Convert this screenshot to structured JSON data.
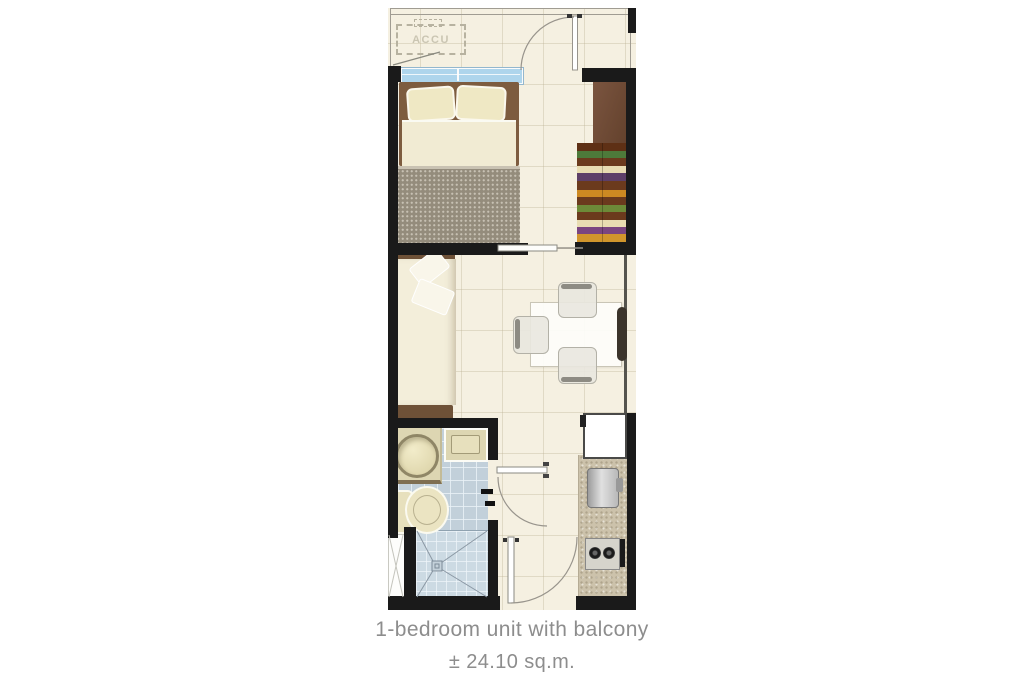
{
  "plan": {
    "accu_label": "ACCU"
  },
  "caption": {
    "title": "1-bedroom unit with balcony",
    "area": "± 24.10 sq.m."
  },
  "colors": {
    "wall": "#1a1a1a",
    "floor": "#f5f0e1",
    "bathroom_tile": "#c2d0da",
    "window_glass": "#aed5ec",
    "bed_frame_brown": "#7d5c3f",
    "blanket_taupe": "#948c7c",
    "wardrobe_brown": "#6f4a33",
    "kitchen_counter": "#ccc2ab",
    "caption_text": "#8d8d8d"
  }
}
